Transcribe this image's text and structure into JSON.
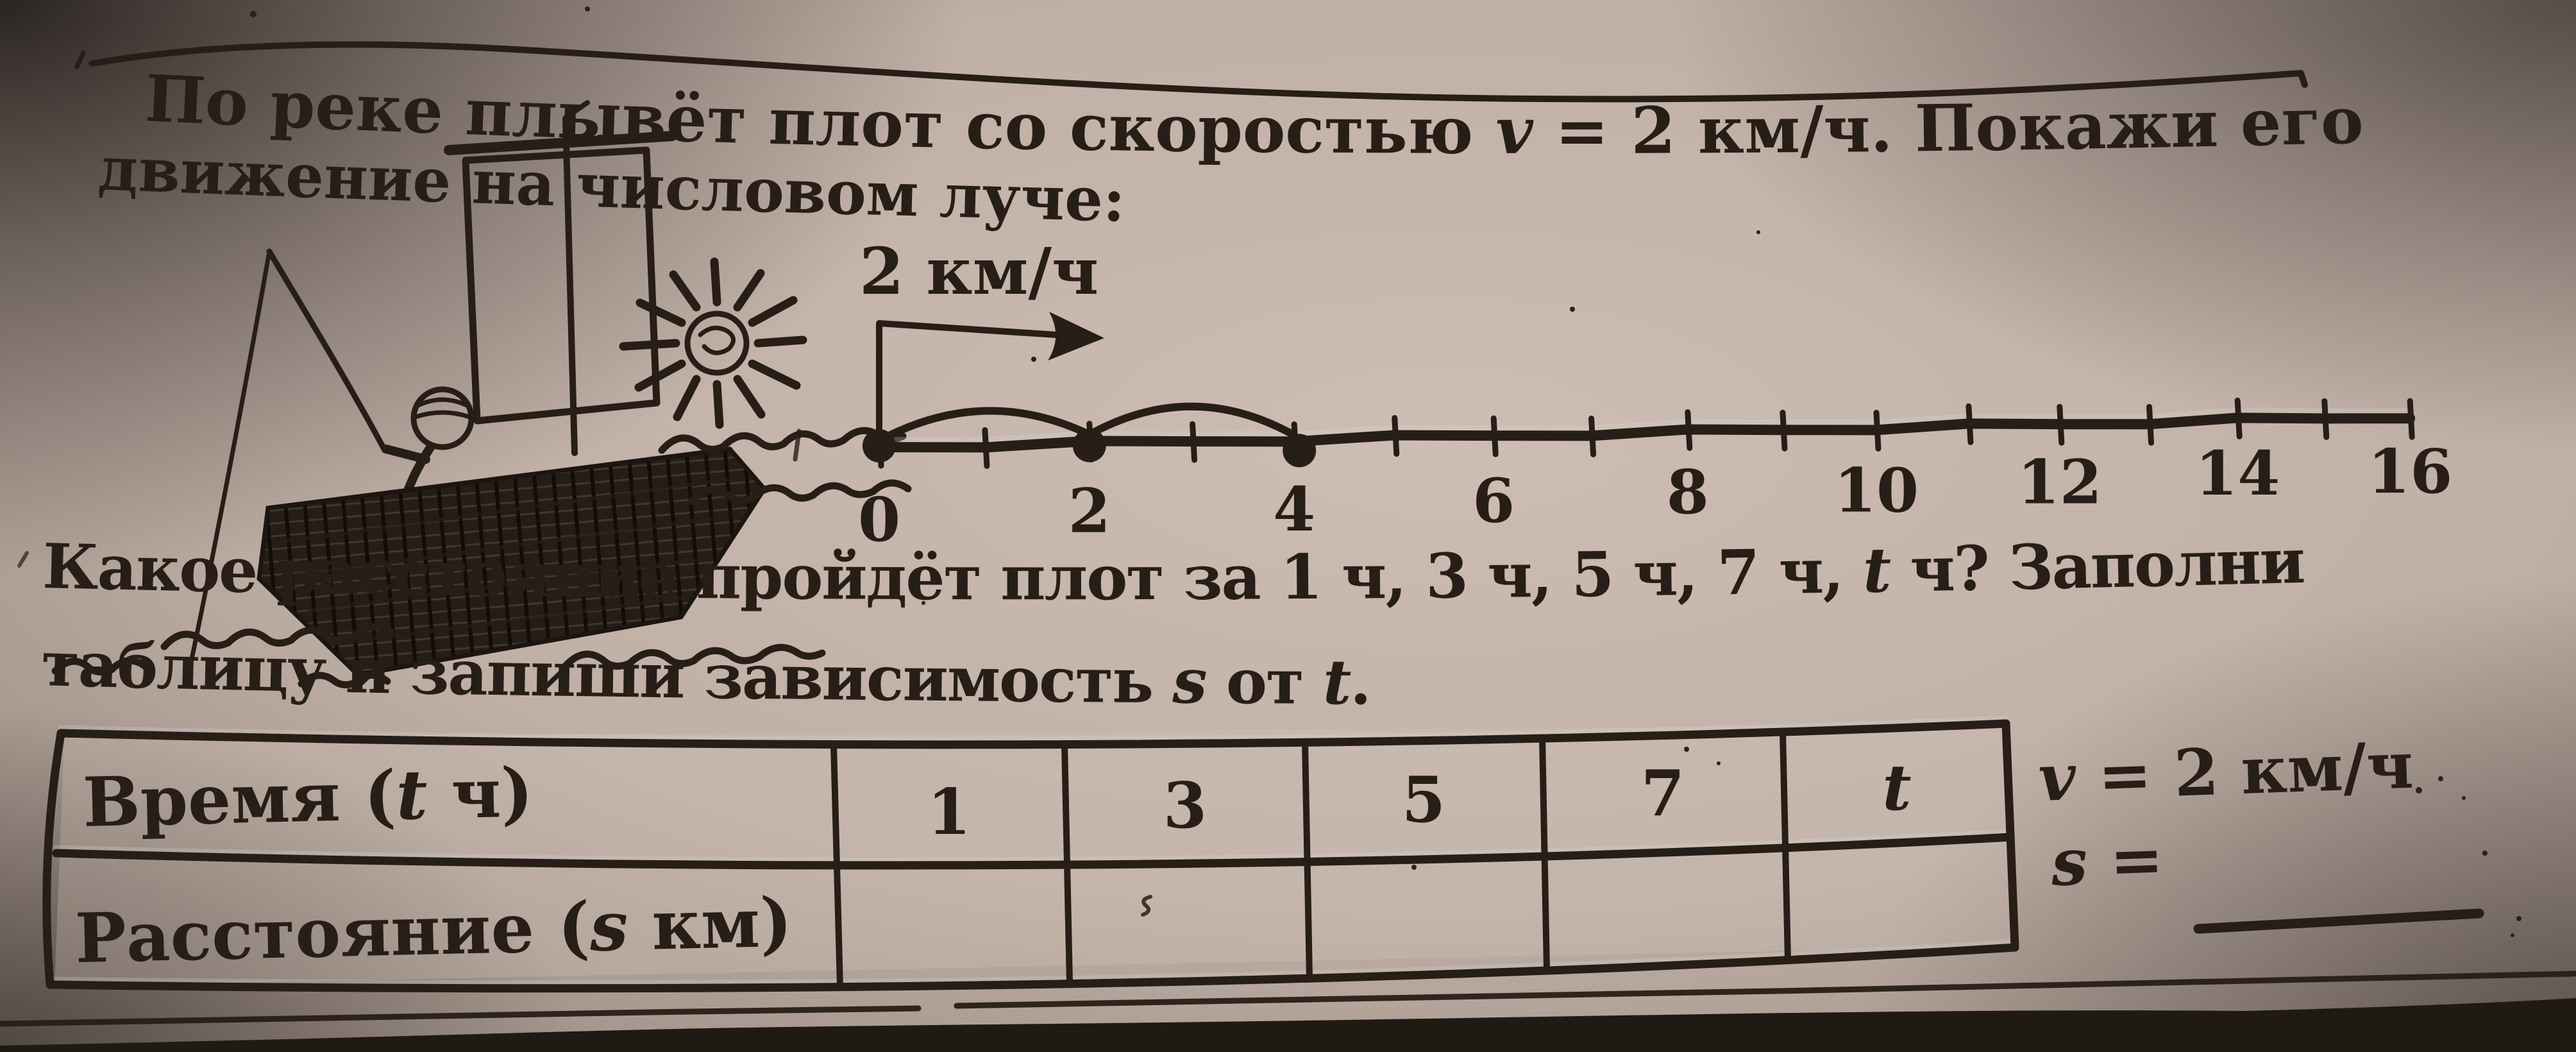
{
  "problem": {
    "line1_pre": "По реке плывёт плот со скоростью ",
    "line1_var": "v",
    "line1_post": " = 2 км/ч. Покажи его",
    "line2": "движение на числовом луче:",
    "q1_pre": "Какое расстояние пройдёт плот за 1 ч, 3 ч, 5 ч, 7 ч, ",
    "q1_var": "t",
    "q1_post": " ч? Заполни",
    "q2_pre": "таблицу и запиши зависимость ",
    "q2_s": "s",
    "q2_mid": " от ",
    "q2_t": "t",
    "q2_end": "."
  },
  "diagram": {
    "illustration": "hand-drawn raft with fisherman, sail and sun floating on river waves",
    "speed_label": "2 км/ч",
    "number_line": {
      "min": 0,
      "max": 16,
      "tick_step": 1,
      "labels": [
        0,
        2,
        4,
        6,
        8,
        10,
        12,
        14,
        16
      ],
      "marked_points": [
        0,
        2,
        4
      ],
      "hops": [
        [
          0,
          2
        ],
        [
          2,
          4
        ]
      ]
    }
  },
  "table": {
    "row1_pre": "Время (",
    "row1_var": "t",
    "row1_post": " ч)",
    "row2_pre": "Расстояние (",
    "row2_var": "s",
    "row2_post": " км)",
    "time_values": [
      "1",
      "3",
      "5",
      "7",
      "t"
    ],
    "distance_values": [
      "",
      "",
      "",
      "",
      ""
    ]
  },
  "side": {
    "v_var": "v",
    "v_rest": " = 2 км/ч",
    "s_var": "s",
    "s_rest": " ="
  }
}
